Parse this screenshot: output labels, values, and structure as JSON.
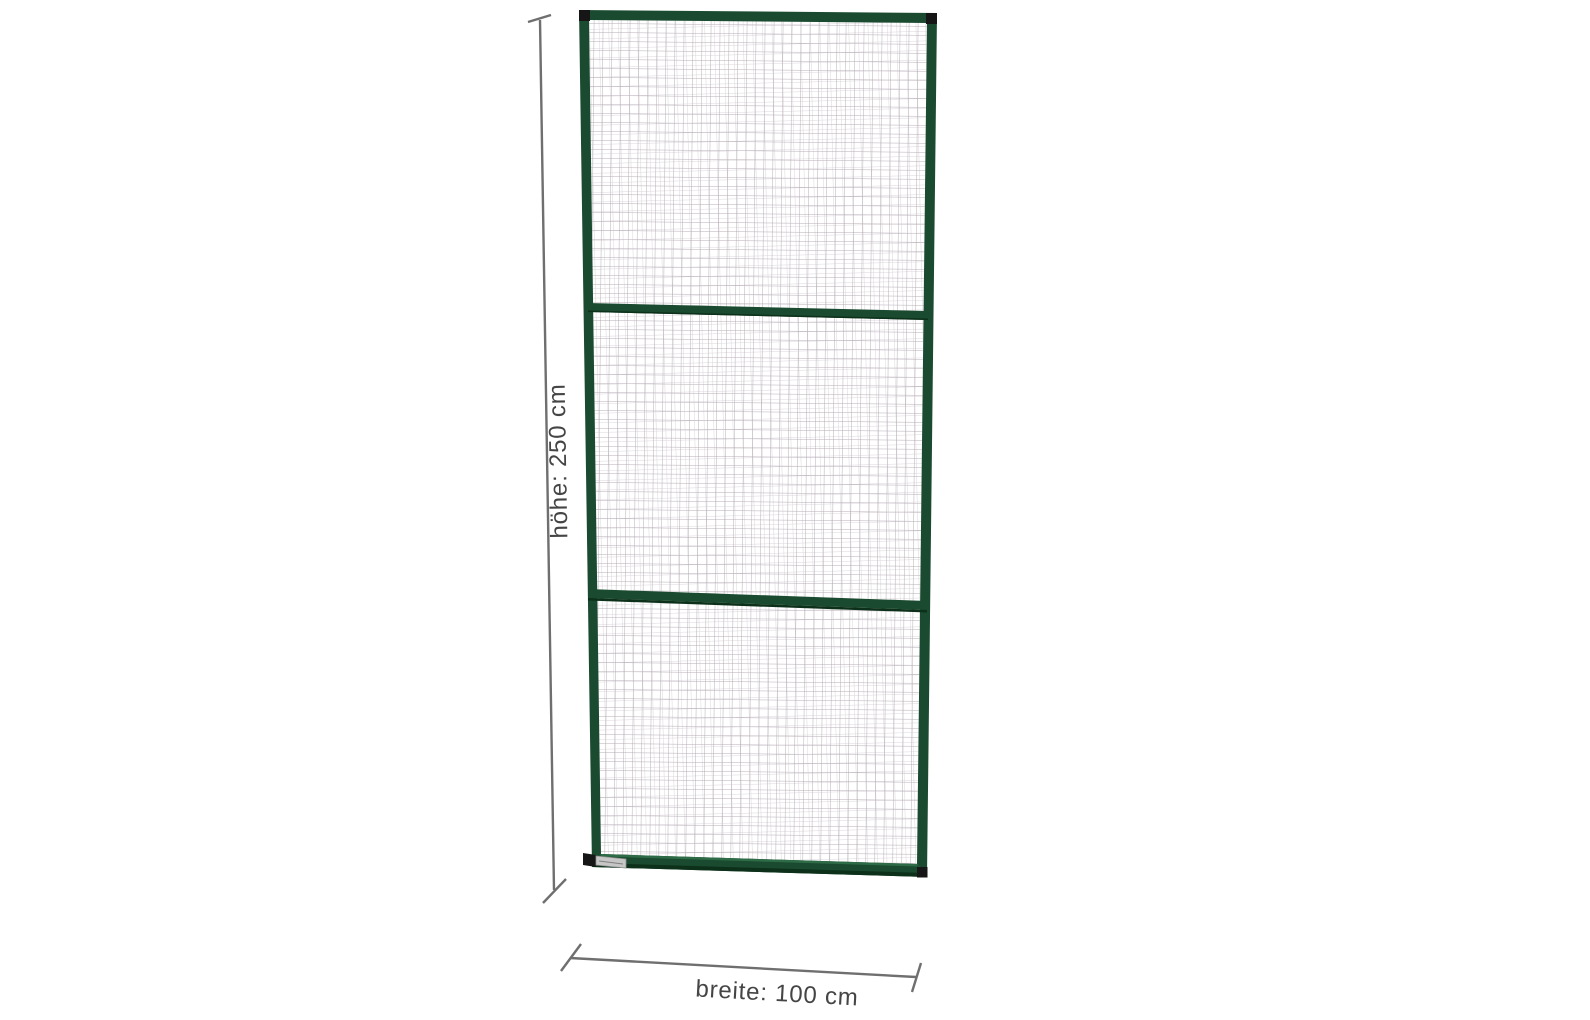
{
  "labels": {
    "height": "höhe: 250 cm",
    "width": "breite: 100 cm"
  },
  "panel": {
    "mesh_sections": 3,
    "crossbars": 2
  },
  "icons": {
    "height_dimension": "vertical-dimension-line-with-end-ticks",
    "width_dimension": "horizontal-dimension-line-with-end-ticks",
    "label_plate": "type-label-plate"
  },
  "colors": {
    "background": "#ffffff",
    "frame_green": "#1a4a2f",
    "frame_shadow": "#0c3019",
    "frame_highlight": "#2e6b47",
    "corner_cap": "#161616",
    "mesh_front": "#b6aeb6",
    "mesh_back": "#dad5da",
    "dimension_line": "#6f6f6f",
    "label_text": "#454545",
    "plate_silver": "#c6c6c6",
    "plate_dark": "#2a2a2a"
  }
}
